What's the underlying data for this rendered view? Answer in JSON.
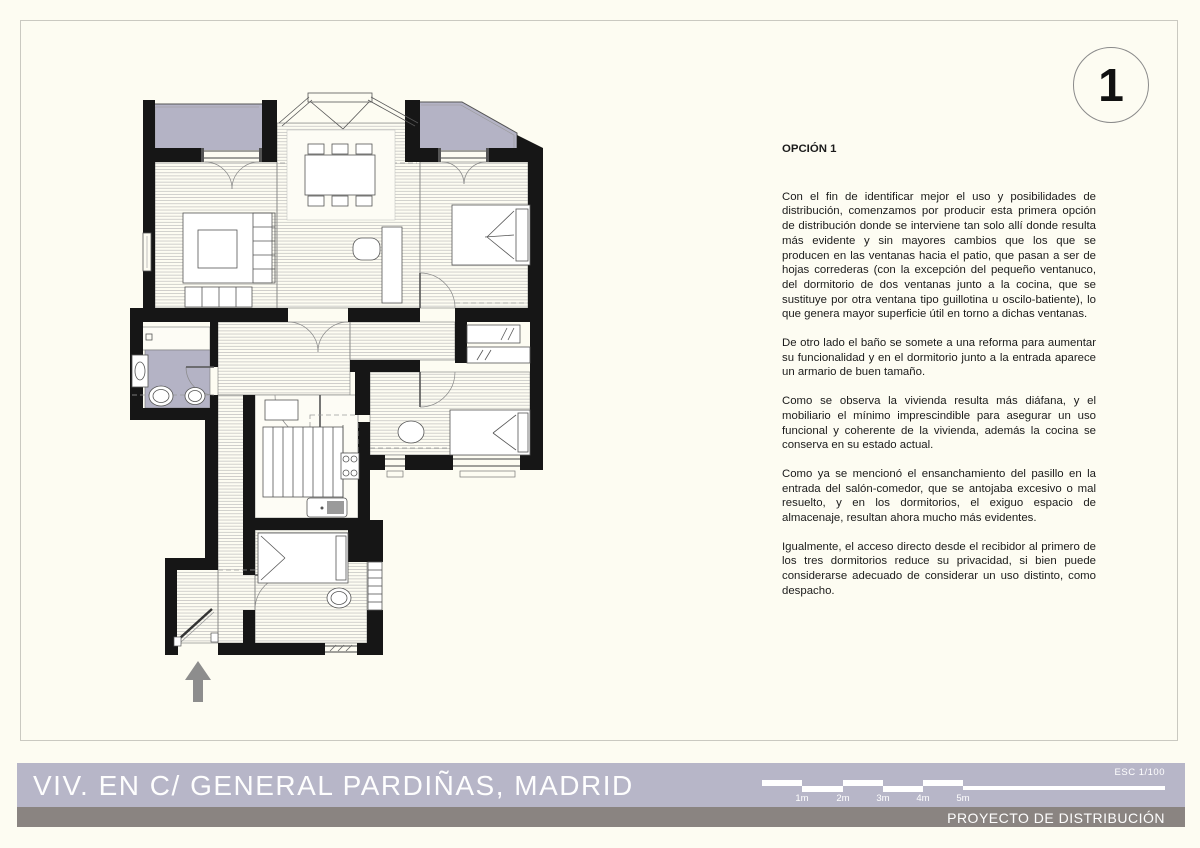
{
  "sheet": {
    "number": "1"
  },
  "notes": {
    "heading": "OPCIÓN 1",
    "paragraphs": [
      "Con el fin de identificar mejor el uso y posibilidades de distribución, comenzamos por producir esta primera opción de distribución donde se interviene tan solo allí donde resulta más evidente y sin mayores cambios que los que se producen en las ventanas hacia el patio, que pasan a ser de hojas correderas (con la excepción del pequeño ventanuco, del dormitorio de dos ventanas junto a la cocina, que se sustituye por otra ventana tipo guillotina u oscilo-batiente), lo que genera mayor superficie útil en torno a dichas ventanas.",
      "De otro lado el baño se somete a una reforma para aumentar su funcionalidad y en el dormitorio junto a la entrada aparece un armario de buen tamaño.",
      "Como se observa la vivienda resulta más diáfana, y el mobiliario el mínimo imprescindible para asegurar un uso funcional y coherente de la vivienda, además la cocina se conserva en su estado actual.",
      "Como ya se mencionó el ensanchamiento del pasillo en la entrada del salón-comedor, que se antojaba excesivo o mal resuelto, y en los dormitorios, el exiguo espacio de almacenaje, resultan ahora mucho más evidentes.",
      "Igualmente, el acceso directo desde el recibidor al primero de los tres dormitorios reduce su privacidad, si bien puede considerarse adecuado de considerar un uso distinto, como despacho."
    ]
  },
  "footer": {
    "title": "VIV. EN C/ GENERAL PARDIÑAS, MADRID",
    "subtitle": "PROYECTO DE DISTRIBUCIÓN",
    "scale_label": "ESC 1/100",
    "scale_ticks": [
      "1m",
      "2m",
      "3m",
      "4m",
      "5m"
    ]
  },
  "colors": {
    "paper": "#fdfcf2",
    "lavender": "#b7b6c8",
    "terrace_lavender": "#b4b3c5",
    "bar_gray": "#8a8481",
    "wall_black": "#161616",
    "arrow_gray": "#8d8d8d"
  }
}
